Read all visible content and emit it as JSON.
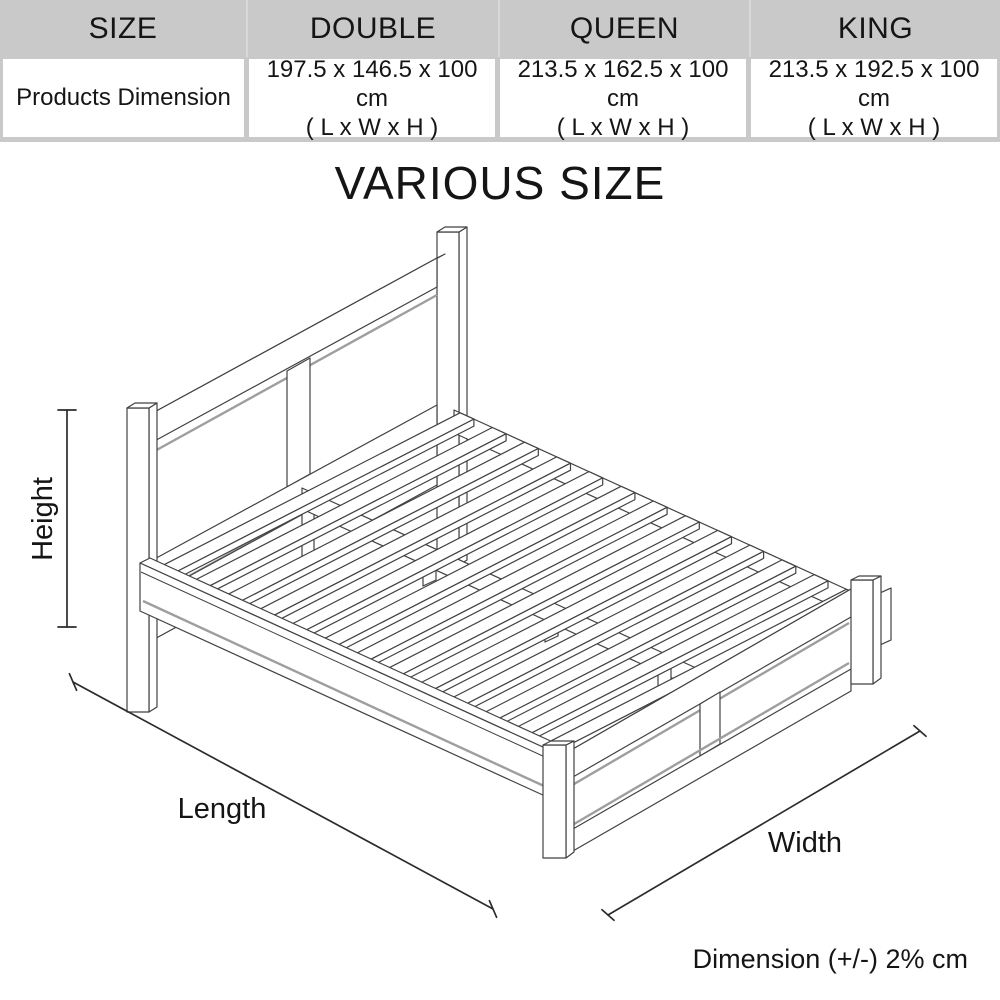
{
  "table": {
    "columns": [
      "SIZE",
      "DOUBLE",
      "QUEEN",
      "KING"
    ],
    "row_label": "Products Dimension",
    "cells": [
      {
        "dims": "197.5 x 146.5 x 100 cm",
        "axes": "( L x W x H )"
      },
      {
        "dims": "213.5 x 162.5 x 100 cm",
        "axes": "( L x W x H )"
      },
      {
        "dims": "213.5 x 192.5 x 100 cm",
        "axes": "( L x W x H )"
      }
    ]
  },
  "title": "VARIOUS SIZE",
  "diagram": {
    "height_label": "Height",
    "length_label": "Length",
    "width_label": "Width",
    "note": "Dimension (+/-) 2% cm"
  },
  "colors": {
    "table_header_bg": "#c9c9c9",
    "table_gap": "#d9d9d9",
    "line": "#424242",
    "shadow": "#9e9e9e",
    "text": "#151515"
  }
}
